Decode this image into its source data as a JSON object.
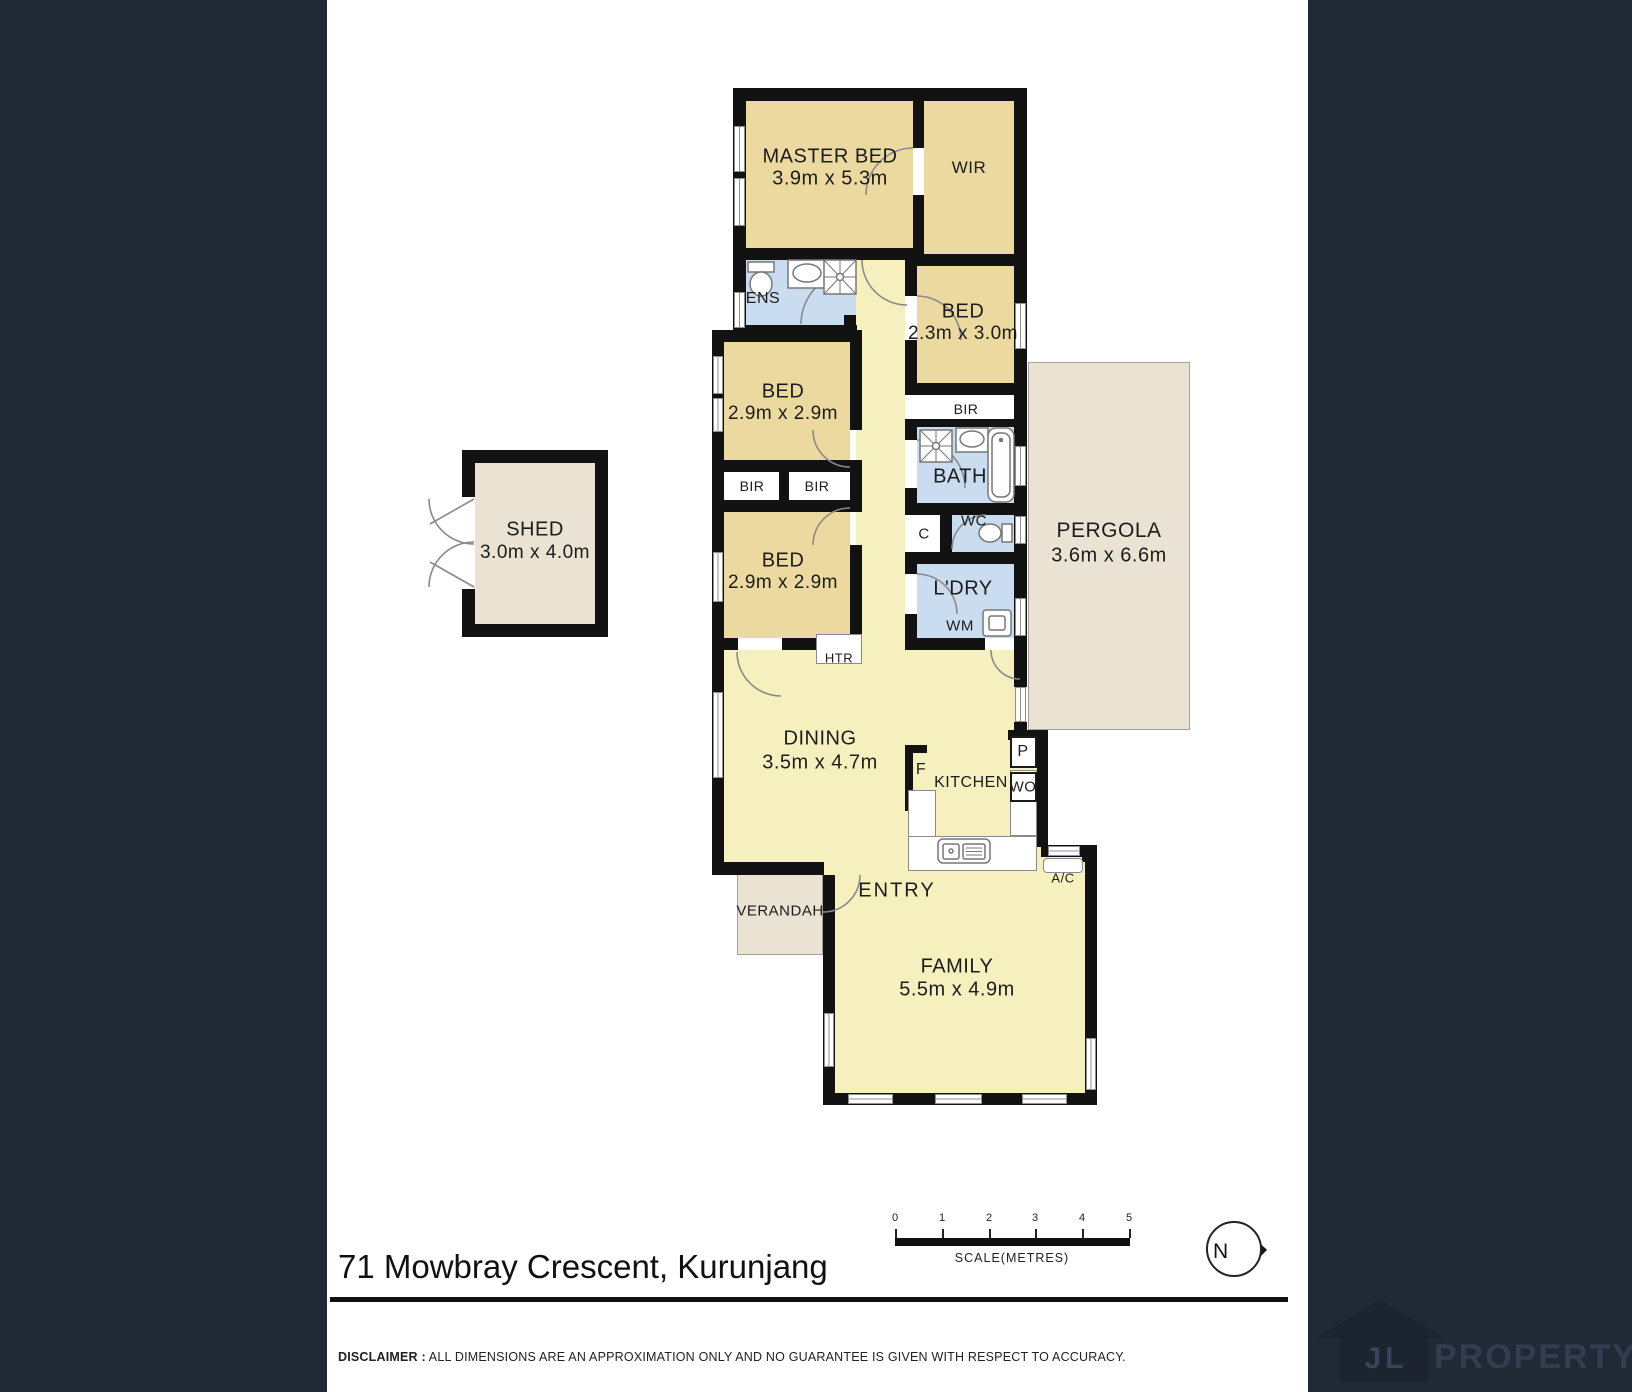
{
  "colors": {
    "sidebar": "#212936",
    "wall": "#121212",
    "bedroom_fill": "#ecd9a0",
    "wet_area_fill": "#c9dcf0",
    "living_fill": "#f6f0bf",
    "outdoor_fill": "#eae3d3"
  },
  "rooms": {
    "master": {
      "label": "MASTER BED",
      "dims": "3.9m x 5.3m"
    },
    "wir": {
      "label": "WIR"
    },
    "ens": {
      "label": "ENS"
    },
    "bed_small": {
      "label": "BED",
      "dims": "2.3m x 3.0m"
    },
    "bed_mid": {
      "label": "BED",
      "dims": "2.9m x 2.9m"
    },
    "bed_low": {
      "label": "BED",
      "dims": "2.9m x 2.9m"
    },
    "bir1": {
      "label": "BIR"
    },
    "bir2": {
      "label": "BIR"
    },
    "bir3": {
      "label": "BIR"
    },
    "bath": {
      "label": "BATH"
    },
    "wc": {
      "label": "WC"
    },
    "closet": {
      "label": "C"
    },
    "laundry": {
      "label": "L'DRY"
    },
    "wm": {
      "label": "WM"
    },
    "htr": {
      "label": "HTR"
    },
    "shed": {
      "label": "SHED",
      "dims": "3.0m x 4.0m"
    },
    "pergola": {
      "label": "PERGOLA",
      "dims": "3.6m x 6.6m"
    },
    "dining": {
      "label": "DINING",
      "dims": "3.5m x 4.7m"
    },
    "kitchen": {
      "label": "KITCHEN"
    },
    "fridge": {
      "label": "F"
    },
    "pantry": {
      "label": "P"
    },
    "wall_oven": {
      "label": "WO"
    },
    "ac": {
      "label": "A/C"
    },
    "entry": {
      "label": "ENTRY"
    },
    "verandah": {
      "label": "VERANDAH"
    },
    "family": {
      "label": "FAMILY",
      "dims": "5.5m x 4.9m"
    }
  },
  "footer": {
    "address": "71 Mowbray Crescent, Kurunjang",
    "disclaimer_label": "DISCLAIMER :",
    "disclaimer_text": " ALL DIMENSIONS ARE AN APPROXIMATION ONLY AND NO GUARANTEE IS GIVEN WITH RESPECT TO ACCURACY."
  },
  "scale_bar": {
    "ticks": [
      "0",
      "1",
      "2",
      "3",
      "4",
      "5"
    ],
    "label": "SCALE(METRES)"
  },
  "compass": {
    "north_label": "N"
  },
  "brand": {
    "initials": "JL",
    "name": "PROPERTY"
  }
}
